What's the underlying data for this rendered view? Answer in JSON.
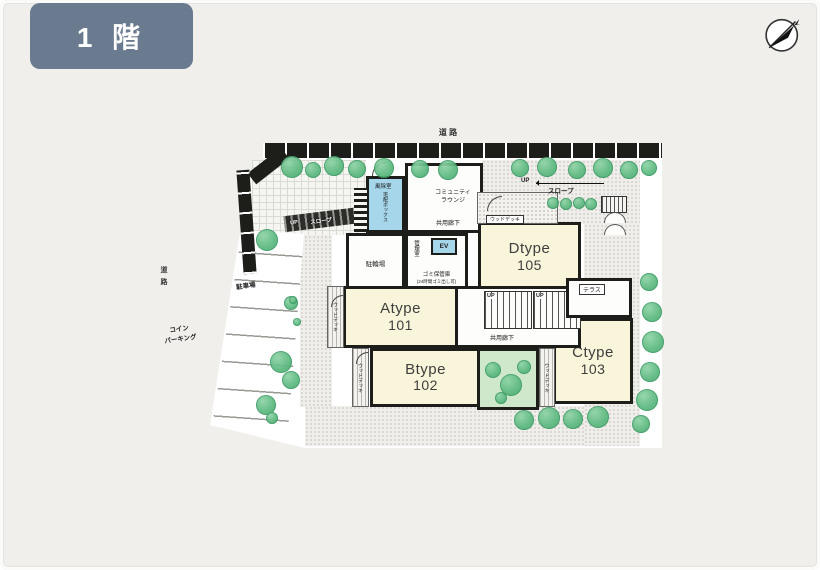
{
  "floor_tab": {
    "label": "1 階"
  },
  "colors": {
    "badge": "#6a7a8f",
    "cream": "#f9f5da",
    "blue": "#a6d6ea",
    "garden": "#cfe8cb",
    "tree": "#5bb87e",
    "road": "#1d1d1a",
    "wall": "#1d1d1a",
    "page": "#f0efec"
  },
  "roads": {
    "top": "道 路",
    "left": "道路"
  },
  "parking": {
    "coin_line1": "コイン",
    "coin_line2": "パーキング",
    "lot": "駐車場"
  },
  "ramps": {
    "left_up": "UP",
    "left_label": "スロープ",
    "top_up": "UP",
    "top_label": "スロープ"
  },
  "facilities": {
    "windbreak": "風除室",
    "delivery_box": "宅配ボックス",
    "lounge_line1": "コミュニティ",
    "lounge_line2": "ラウンジ",
    "corridor_top": "共用廊下",
    "corridor_mid": "共用廊下",
    "bicycle": "駐輪場",
    "management": "管理室",
    "elevator": "EV",
    "garbage_line1": "ゴミ保管庫",
    "garbage_line2": "(24時間ゴミ出し可)",
    "terrace": "テラス",
    "deck": "ウッドデッキ",
    "stairs_up": "UP"
  },
  "units": [
    {
      "type": "Atype",
      "room": "101"
    },
    {
      "type": "Btype",
      "room": "102"
    },
    {
      "type": "Ctype",
      "room": "103"
    },
    {
      "type": "Dtype",
      "room": "105"
    }
  ]
}
